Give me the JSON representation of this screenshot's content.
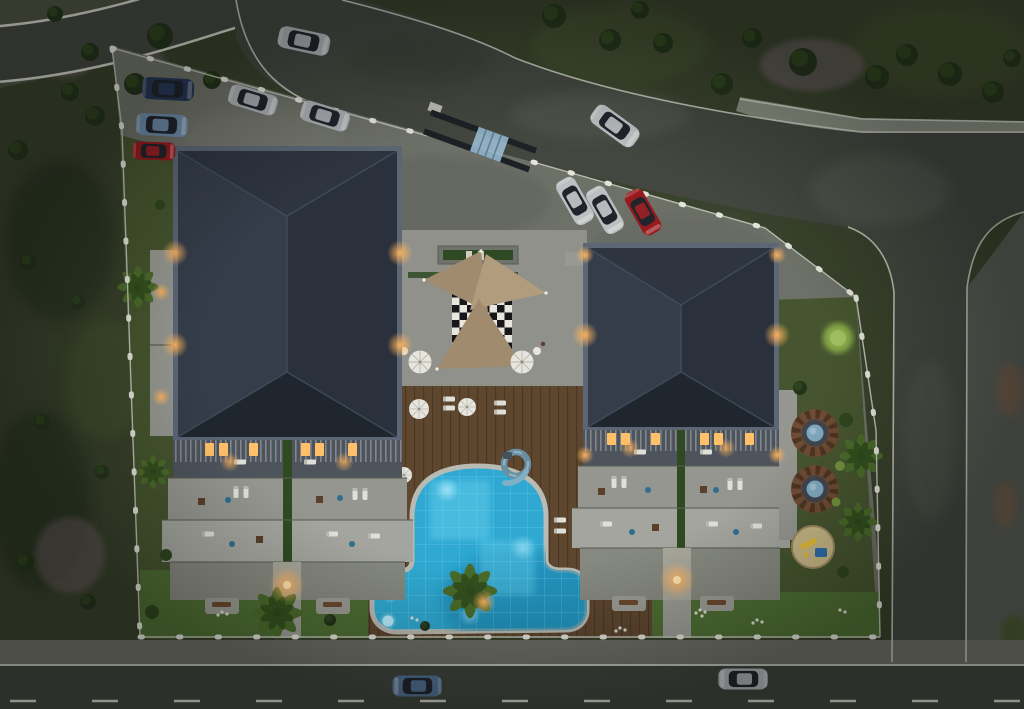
{
  "scene": {
    "title": "Aerial night 3D render of a residential complex site plan",
    "time_of_day": "dusk",
    "view": "top-down"
  },
  "objects": {
    "buildings": [
      "block-a-west",
      "block-b-east"
    ],
    "amenities": [
      "swimming-pool",
      "water-slide",
      "palm-island",
      "wooden-sun-deck",
      "shade-sails",
      "checkerboard-patio",
      "patio-umbrellas",
      "spa-pergola-1",
      "spa-pergola-2",
      "round-playground",
      "north-planter",
      "garden-benches",
      "perimeter-fence",
      "entrance-gate"
    ],
    "vehicles": {
      "total": 12,
      "driving": [
        "silver-car-top-road",
        "white-car-top-road",
        "steel-blue-car-bottom-road",
        "silver-car-bottom-road"
      ],
      "parked": [
        "dark-blue-sedan",
        "light-blue-sedan",
        "red-hatchback",
        "silver-sedan-plaza-1",
        "silver-sedan-plaza-2",
        "white-sedan-center-1",
        "white-sedan-center-2",
        "red-sedan-center"
      ]
    },
    "vegetation": [
      "lawns",
      "dark-shrubs",
      "palm-trees",
      "lit-tree",
      "white-flower-clusters",
      "gravel-flower-beds"
    ]
  },
  "colors": {
    "base_grass_dark": "#39422c",
    "grass_mid": "#46552f",
    "grass_bright": "#4e6e33",
    "terrain_rough": "#4c5142",
    "terrain_dark_patch": "#2b3421",
    "gravel_purple": "#6d5f62",
    "road_asphalt": "#43473f",
    "road_dark": "#3d423b",
    "sidewalk": "#6a6d62",
    "sidewalk_light": "#868a7d",
    "curb_white": "#cdd0c4",
    "plaza": "#62665e",
    "plaza_light": "#6e7168",
    "pavement_east": "#565a52",
    "courtyard": "#8f918a",
    "paving_light": "#9a9c94",
    "roof_parapet": "#5c6675",
    "roof_top": "#2e3540",
    "roof_left": "#353d4a",
    "roof_right": "#2a313c",
    "roof_bottom": "#20262e",
    "roof_ridge": "#46505f",
    "terrace_light": "#a3a59e",
    "terrace_mid": "#94968f",
    "terrace_dark": "#86897f",
    "railing_dark": "#4e545c",
    "railing_slat": "#b3b8bd",
    "hedge_green": "#2f4a22",
    "deck_wood": "#5e462f",
    "deck_plank": "#463télé",
    "deck_line": "#3f3categ",
    "pool_coping": "#b9bbb2",
    "pool_water": "#2fa9d2",
    "pool_water_deep": "#1e86b0",
    "pool_water_bright": "#63cdec",
    "pool_glow": "#b9eeff",
    "pool_tile_line": "#8edcf2",
    "sail_tan": "#a08b6e",
    "sail_tan_light": "#b29c7e",
    "checker_light": "#e8e7df",
    "checker_dark": "#17171a",
    "umbrella_white": "#e6e6df",
    "umbrella_rib": "#b5b5aa",
    "pergola_wood": "#6e4c34",
    "pergola_slat": "#4e3423",
    "pergola_inner": "#41454d",
    "spa_water": "#7fa9bf",
    "sand": "#c7b786",
    "slide_yellow": "#e2bc3a",
    "play_blue": "#2f6fa8",
    "light_warm": "#ffb45e",
    "light_window": "#ffc069",
    "tree_dark": "#24331c",
    "tree_mid": "#31471f",
    "tree_lit": "#8aac4a",
    "palm_green": "#4a6b2a",
    "palm_dark": "#2f4a1c",
    "car_silver": "#c9ccd1",
    "car_white": "#dde0e2",
    "car_dark_blue": "#2a3f63",
    "car_light_blue": "#7fa3c4",
    "car_red": "#b01f24",
    "car_steel_blue": "#5c80a6",
    "car_glass": "#20242b",
    "gate_dark": "#1d2025",
    "gate_glass": "#9fc3da",
    "flower_white": "#d9ded2",
    "fence_post": "#e2e4da",
    "fence_line": "#b9bdb0",
    "lane_dash": "#c9ccc0",
    "rock_brown": "#6b5a48",
    "bench_brown": "#6b4a2e",
    "furn_white": "#dfe0d8",
    "furn_blue": "#2e6f8e",
    "furn_brown": "#5a3f2a"
  }
}
